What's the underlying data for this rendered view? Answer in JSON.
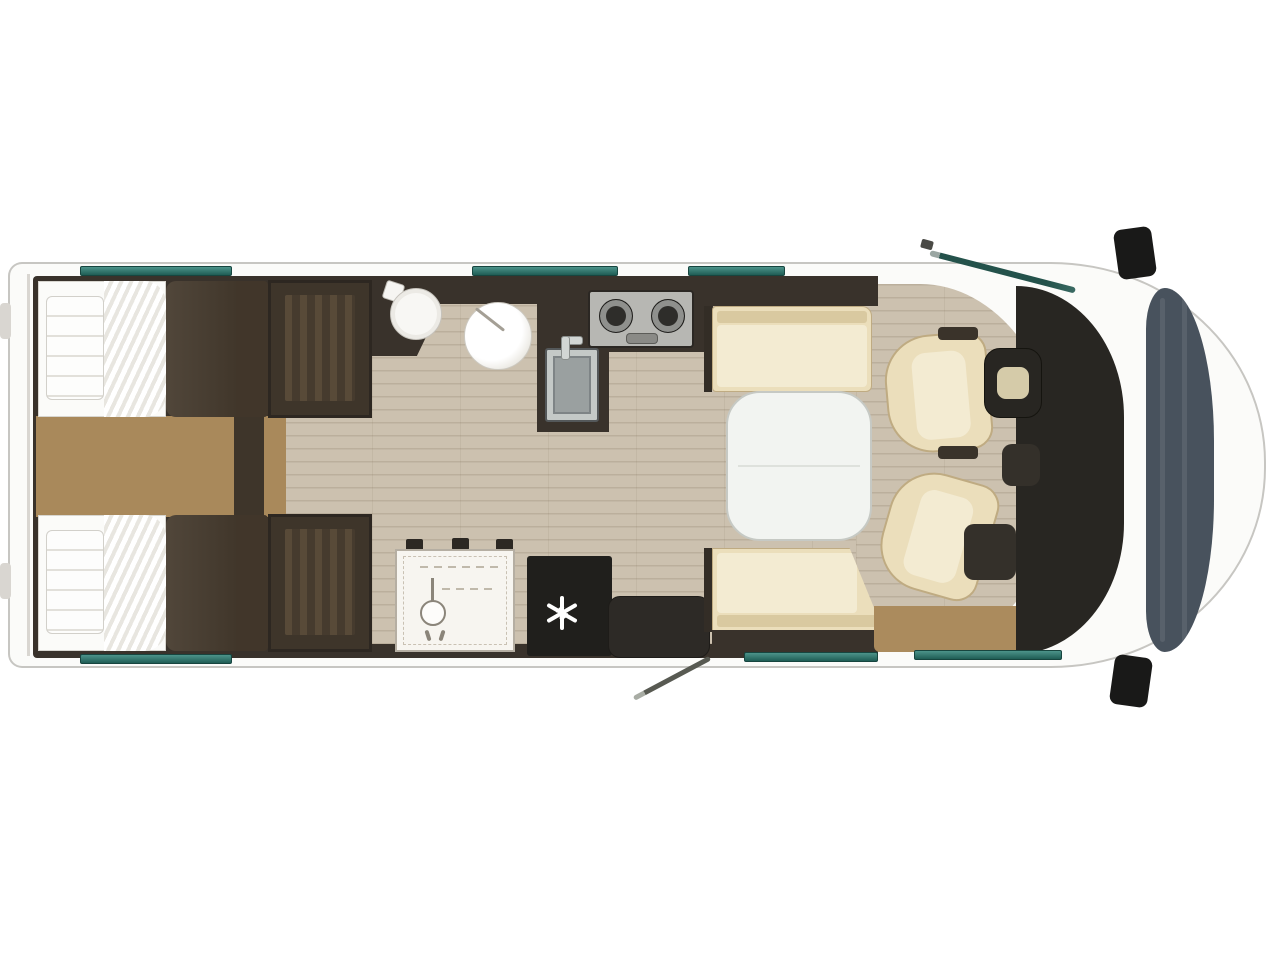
{
  "meta": {
    "type": "motorhome-floor-plan-top-view",
    "visible_text": "none",
    "orientation": "rear-left-front-right"
  },
  "palette": {
    "body_white": "#fbfbf9",
    "outline_gray": "#c7c6c2",
    "interior_dark": "#39322b",
    "wall_dark": "#2f2b25",
    "furniture_dark": "#463b2e",
    "wardrobe_dark": "#3e352a",
    "wood_floor": "#ccc1af",
    "carpet_tan": "#a9895b",
    "cream": "#ebdebb",
    "cream_dark": "#d9c9a0",
    "cream_light": "#f3ebd2",
    "cream_border": "#bfab82",
    "table_white": "#f2f4f1",
    "teal": "#2c756c",
    "teal_dark": "#17453f",
    "fridge_black": "#201f1c",
    "steel": "#9aa0a0",
    "steel_dark": "#54585a",
    "cooktop_gray": "#b7b7b3",
    "windshield_slate": "#48525d",
    "dashboard_dark": "#282622",
    "mat_tan": "#ab8b5d",
    "line_gray": "#d9d6d1"
  },
  "rooms": [
    "rear-bedroom-twin-beds",
    "bathroom-with-separate-shower",
    "kitchen-galley",
    "dinette-lounge",
    "driver-cab"
  ],
  "fixtures": [
    "twin-bed-top",
    "twin-bed-bottom",
    "pillows",
    "duvets",
    "wardrobe-top",
    "wardrobe-bottom",
    "bedroom-carpet",
    "toilet",
    "washbasin",
    "shower-tray",
    "shower-head-icon",
    "two-burner-hob",
    "kitchen-sink",
    "refrigerator",
    "snowflake-icon",
    "entry-step",
    "entry-door-open",
    "dinette-bench-front",
    "dinette-bench-rear",
    "dinette-table",
    "driver-swivel-seat",
    "passenger-swivel-seat",
    "steering-wheel",
    "dashboard",
    "windshield",
    "side-mirror-top",
    "side-mirror-bottom",
    "cab-door-open"
  ],
  "windows": {
    "top_count": 3,
    "bottom_count": 3,
    "color": "#2c756c"
  },
  "counts": {
    "beds": 2,
    "belted_cab_seats": 2,
    "burners": 2
  }
}
